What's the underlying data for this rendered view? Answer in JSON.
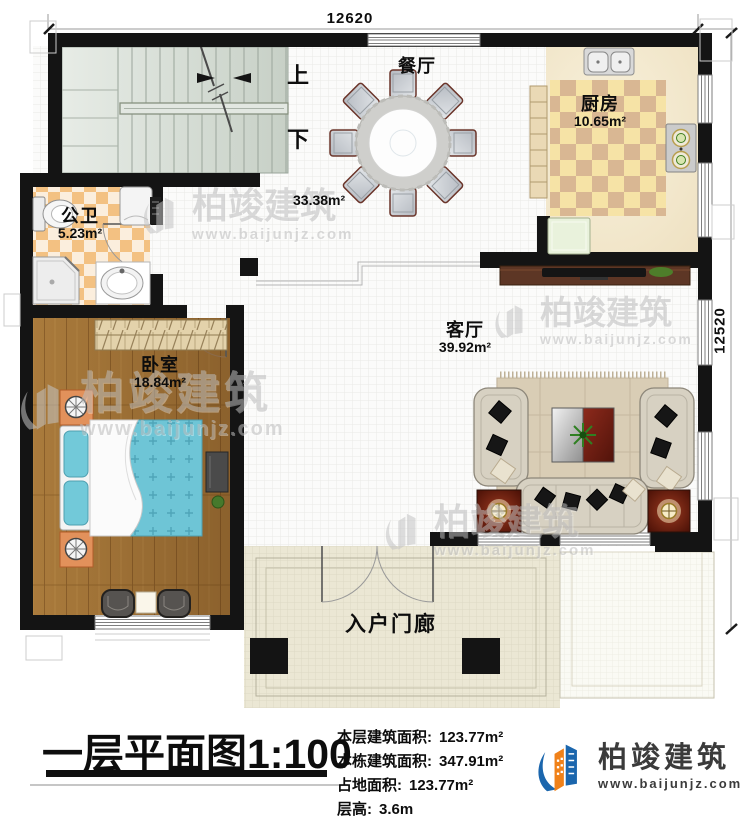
{
  "colors": {
    "wall": "#141414",
    "logo_blue": "#1b66ad",
    "logo_orange": "#f08119",
    "bed_teal": "#6ec5d6",
    "wood_floor": "#aa7b3c",
    "bath_checker": "#f3c182",
    "kitchen_checker": "#d9b793",
    "watermark_gray": "#bdbdbd"
  },
  "dimensions": {
    "top": "12620",
    "right": "12520"
  },
  "stairs": {
    "up_label": "上",
    "down_label": "下"
  },
  "rooms": {
    "dining": {
      "name": "餐厅",
      "area": "33.38m²"
    },
    "kitchen": {
      "name": "厨房",
      "area": "10.65m²"
    },
    "bathroom": {
      "name": "公卫",
      "area": "5.23m²"
    },
    "bedroom": {
      "name": "卧室",
      "area": "18.84m²"
    },
    "living": {
      "name": "客厅",
      "area": "39.92m²"
    },
    "porch": {
      "name": "入户门廊"
    }
  },
  "watermark": {
    "name": "柏竣建筑",
    "url": "www.baijunjz.com"
  },
  "footer": {
    "title": "一层平面图1:100",
    "stats": [
      {
        "label": "本层建筑面积:",
        "value": "123.77m²"
      },
      {
        "label": "本栋建筑面积:",
        "value": "347.91m²"
      },
      {
        "label": "占地面积:",
        "value": "123.77m²"
      },
      {
        "label": "层高:",
        "value": "3.6m"
      }
    ],
    "logo": {
      "name": "柏竣建筑",
      "url": "www.baijunjz.com"
    }
  }
}
